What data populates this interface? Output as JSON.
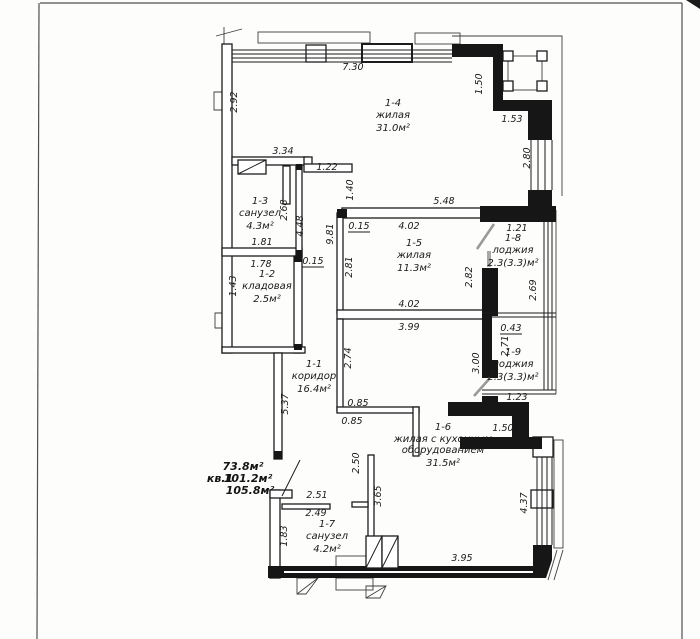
{
  "plan": {
    "line_color": "#1c1c1c",
    "rooms": [
      {
        "id": "1-4",
        "name": "жилая",
        "area": "31.0м²",
        "x": 393,
        "y": 106
      },
      {
        "id": "1-3",
        "name": "санузел",
        "area": "4.3м²",
        "x": 260,
        "y": 204
      },
      {
        "id": "1-5",
        "name": "жилая",
        "area": "11.3м²",
        "x": 414,
        "y": 246
      },
      {
        "id": "1-8",
        "name": "лоджия",
        "area": "2.3(3.3)м²",
        "x": 513,
        "y": 241
      },
      {
        "id": "1-2",
        "name": "кладовая",
        "area": "2.5м²",
        "x": 267,
        "y": 277
      },
      {
        "id": "1-9",
        "name": "лоджия",
        "area": "2.3(3.3)м²",
        "x": 513,
        "y": 355
      },
      {
        "id": "1-1",
        "name": "коридор",
        "area": "16.4м²",
        "x": 314,
        "y": 367
      },
      {
        "id": "1-6",
        "name": "жилая с кухонным",
        "name2": "оборудованием",
        "area": "31.5м²",
        "x": 443,
        "y": 430
      },
      {
        "id": "1-7",
        "name": "санузел",
        "area": "4.2м²",
        "x": 327,
        "y": 527
      }
    ],
    "summary": {
      "area1": "73.8м²",
      "label": "кв.1",
      "area2": "101.2м²",
      "area3": "105.8м²"
    },
    "dims": [
      {
        "v": "7.30",
        "x": 353,
        "y": 70
      },
      {
        "v": "2.92",
        "x": 237,
        "y": 102,
        "r": 1
      },
      {
        "v": "1.50",
        "x": 482,
        "y": 84,
        "r": 1
      },
      {
        "v": "1.53",
        "x": 512,
        "y": 122
      },
      {
        "v": "2.80",
        "x": 530,
        "y": 158,
        "r": 1
      },
      {
        "v": "3.34",
        "x": 283,
        "y": 154
      },
      {
        "v": "1.22",
        "x": 327,
        "y": 170
      },
      {
        "v": "1.40",
        "x": 353,
        "y": 190,
        "r": 1
      },
      {
        "v": "5.48",
        "x": 444,
        "y": 204
      },
      {
        "v": "4.02",
        "x": 409,
        "y": 229
      },
      {
        "v": "0.15",
        "x": 359,
        "y": 229,
        "u": 1
      },
      {
        "v": "1.21",
        "x": 517,
        "y": 231
      },
      {
        "v": "2.68",
        "x": 287,
        "y": 210,
        "r": 1
      },
      {
        "v": "4.48",
        "x": 303,
        "y": 226,
        "r": 1
      },
      {
        "v": "9.81",
        "x": 333,
        "y": 234,
        "r": 1
      },
      {
        "v": "1.81",
        "x": 262,
        "y": 245
      },
      {
        "v": "2.82",
        "x": 472,
        "y": 277,
        "r": 1
      },
      {
        "v": "2.69",
        "x": 536,
        "y": 290,
        "r": 1
      },
      {
        "v": "1.78",
        "x": 261,
        "y": 267
      },
      {
        "v": "0.15",
        "x": 313,
        "y": 264,
        "u": 1
      },
      {
        "v": "2.81",
        "x": 352,
        "y": 267,
        "r": 1
      },
      {
        "v": "1.43",
        "x": 236,
        "y": 286,
        "r": 1
      },
      {
        "v": "4.02",
        "x": 409,
        "y": 307
      },
      {
        "v": "3.99",
        "x": 409,
        "y": 330
      },
      {
        "v": "0.43",
        "x": 511,
        "y": 331,
        "u": 1
      },
      {
        "v": "2.71",
        "x": 508,
        "y": 346,
        "r": 1
      },
      {
        "v": "3.00",
        "x": 479,
        "y": 363,
        "r": 1
      },
      {
        "v": "2.74",
        "x": 351,
        "y": 358,
        "r": 1
      },
      {
        "v": "5.37",
        "x": 288,
        "y": 404,
        "r": 1
      },
      {
        "v": "0.85",
        "x": 358,
        "y": 406
      },
      {
        "v": "0.85",
        "x": 352,
        "y": 424
      },
      {
        "v": "1.23",
        "x": 517,
        "y": 400
      },
      {
        "v": "1.50",
        "x": 503,
        "y": 431
      },
      {
        "v": "2.50",
        "x": 359,
        "y": 463,
        "r": 1
      },
      {
        "v": "4.37",
        "x": 527,
        "y": 503,
        "r": 1
      },
      {
        "v": "2.51",
        "x": 317,
        "y": 498
      },
      {
        "v": "2.49",
        "x": 316,
        "y": 516
      },
      {
        "v": "3.65",
        "x": 381,
        "y": 496,
        "r": 1
      },
      {
        "v": "1.83",
        "x": 287,
        "y": 536,
        "r": 1
      },
      {
        "v": "3.95",
        "x": 462,
        "y": 561
      }
    ]
  }
}
